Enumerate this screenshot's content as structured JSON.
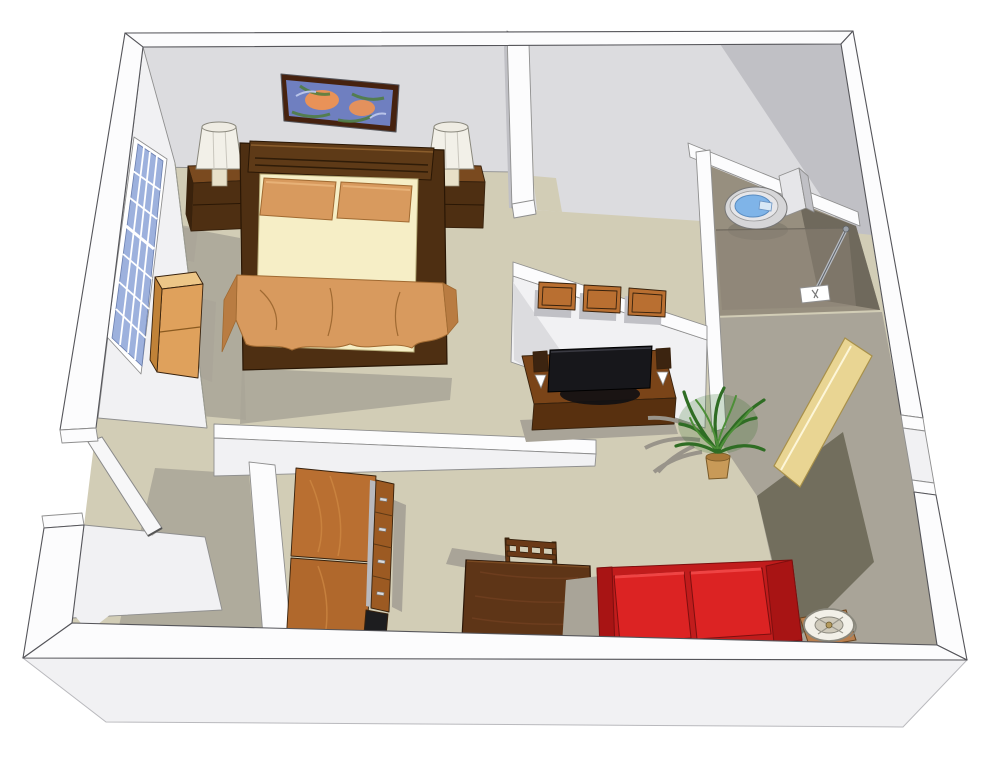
{
  "scene": {
    "type": "3d-floorplan-render",
    "style": "sketchup-isometric-studio-apartment",
    "rooms": [
      {
        "name": "bedroom",
        "objects": [
          "window",
          "wall-art",
          "queen-bed",
          "pillows",
          "blanket",
          "nightstand-left",
          "table-lamp-left",
          "nightstand-right",
          "table-lamp-right",
          "dresser"
        ]
      },
      {
        "name": "storage-room",
        "objects": []
      },
      {
        "name": "bathroom",
        "objects": [
          "toilet",
          "shower-enclosure",
          "shower-rod",
          "shower-valve"
        ]
      },
      {
        "name": "kitchenette",
        "objects": [
          "tall-cabinet-upper",
          "tall-cabinet-lower",
          "drawer-column",
          "oven-cavity"
        ]
      },
      {
        "name": "living-area",
        "objects": [
          "wall-cabinets",
          "media-console",
          "flat-tv",
          "speaker-left",
          "speaker-right",
          "potted-plant",
          "dining-table",
          "dining-chair",
          "red-loveseat",
          "side-table",
          "accent-lamp",
          "entry-door-open"
        ]
      },
      {
        "name": "entry-hall",
        "objects": [
          "entry-door-leaf"
        ]
      }
    ],
    "palette": {
      "bg": "#ffffff",
      "edge": "#8f8f8f",
      "edge_dark": "#55555a",
      "wall_top": "#fcfcfd",
      "wall_face_light": "#f1f1f3",
      "wall_face": "#dcdcdf",
      "wall_face_mid": "#c0c0c5",
      "floor": "#d2cdb6",
      "floor_shadow": "#a9a498",
      "floor_shadow_dark": "#6f6b5a",
      "bath_floor": "#978f7f",
      "bath_floor_dark": "#6f695c",
      "glass": "#8b8274",
      "chrome": "#b8bdc4",
      "water": "#7fb4e8",
      "porcelain": "#e6e6e9",
      "tv": "#17171b",
      "wood_dark": "#4e2f12",
      "wood_medium": "#7a4418",
      "wood_warm": "#b96f31",
      "wood_drawer": "#9c5a22",
      "wood_light": "#dfa15c",
      "wood_pale": "#edc687",
      "wood_edge": "#38220d",
      "mattress": "#f6eec6",
      "mattress_edge": "#b8ad7a",
      "textile": "#d89a5e",
      "textile_dark": "#b97c42",
      "textile_edge": "#a06a32",
      "sofa": "#dc2323",
      "sofa_dark": "#a81414",
      "sofa_deep": "#c11c1c",
      "sofa_edge": "#7d0f0f",
      "plant": "#2f6d24",
      "plant_light": "#4d8f38",
      "plant_shadow": "#99948a",
      "pot": "#c89a58",
      "door_wood": "#e9d593",
      "door_edge": "#a8904a",
      "shade": "#f2f0e8",
      "shade_edge": "#8a887d",
      "art_bg": "#6f7fc0",
      "art_orange": "#ef9452",
      "art_green": "#4f7c3c",
      "art_light": "#b9c4e9",
      "frame": "#46220f",
      "window": "#9db1dd",
      "black": "#1d1d1f",
      "white": "#ffffff",
      "metal": "#d9dadc"
    }
  }
}
